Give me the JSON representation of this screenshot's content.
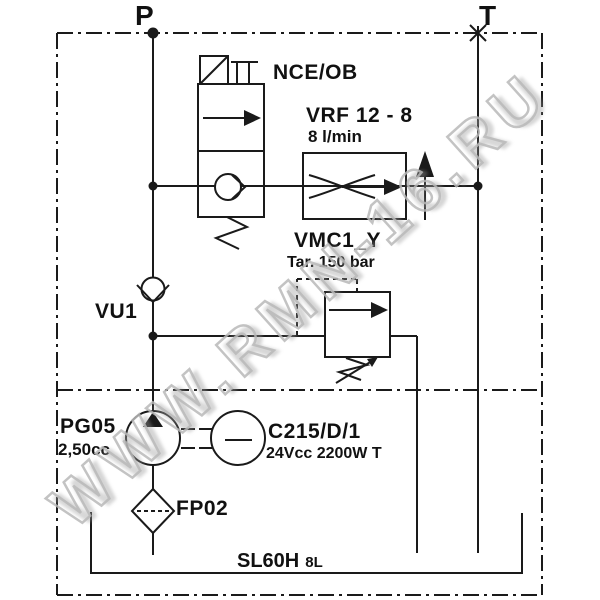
{
  "ports": {
    "p": "P",
    "t": "T"
  },
  "components": {
    "solenoid_valve": {
      "label": "NCE/OB"
    },
    "flow_regulator": {
      "label": "VRF 12 - 8",
      "flow": "8 l/min"
    },
    "relief_valve": {
      "label": "VMC1_Y",
      "setting": "Tar. 150 bar"
    },
    "check_valve": {
      "label": "VU1"
    },
    "pump": {
      "label": "PG05",
      "displacement": "2,50cc"
    },
    "motor": {
      "label": "C215/D/1",
      "spec": "24Vcc 2200W T"
    },
    "filter": {
      "label": "FP02"
    },
    "tank": {
      "label": "SL60H",
      "capacity": "8L"
    }
  },
  "watermark": {
    "text": "WWW.RMN-16.RU"
  },
  "colors": {
    "line": "#1a1a1a",
    "background": "#ffffff",
    "watermark_stroke": "#b9b9b9"
  }
}
